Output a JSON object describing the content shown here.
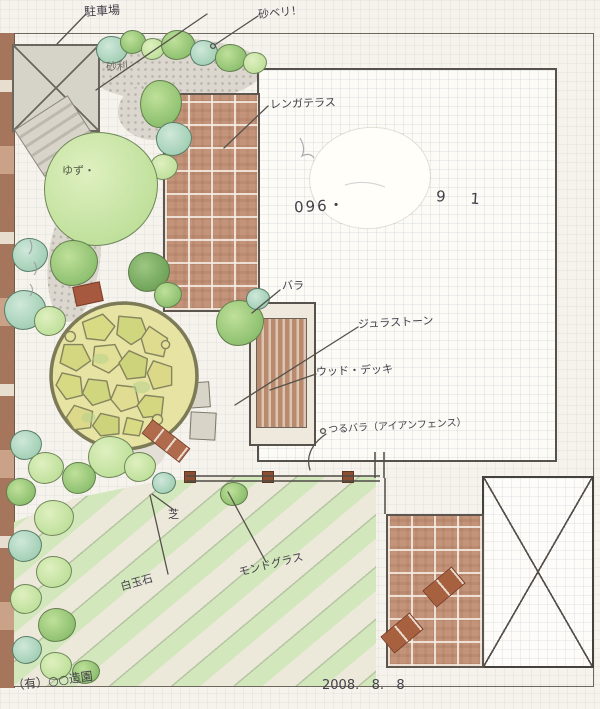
{
  "plan": {
    "labels": {
      "parking": "駐車場",
      "edging": "砂ベリ！",
      "gravel": "砂利",
      "brick_terrace": "レンガテラス",
      "rose": "バラ",
      "jura_stone": "ジュラストーン",
      "wood_deck": "ウッド・デッキ",
      "climbing_rose": "つるバラ（アイアンフェンス）",
      "lawn": "芝",
      "white_stones": "白玉石",
      "mondo_grass": "モンドグラス",
      "yuzu_tree": "ゆず・",
      "phone_prefix": "096・",
      "phone_suffix": "9 1",
      "signature": "（有）○○造園",
      "date": "2008.   8.   8"
    },
    "colors": {
      "paper": "#f6f3ec",
      "ink": "#43404a",
      "brick": "#c3937a",
      "deck_wood": "#b98a6d",
      "patio_stone": "#dcd98a",
      "lawn_green": "#d2e7bb",
      "foliage_light": "#bfe09b",
      "foliage_teal": "#a3cfb5",
      "gravel_grey": "#dbd7ce",
      "wall_brown": "#a5765c"
    }
  }
}
